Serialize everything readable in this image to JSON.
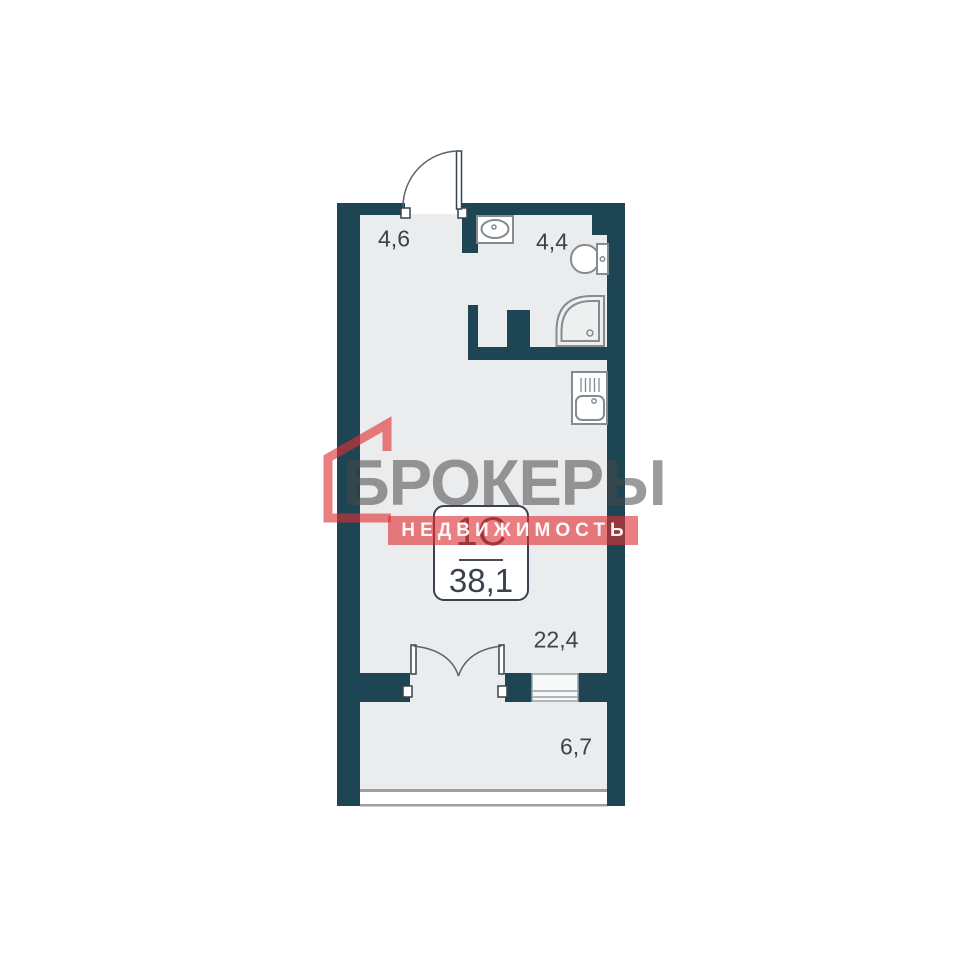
{
  "logo": {
    "brand": "БРОКЕРЫ",
    "subtitle": "НЕДВИЖИМОСТЬ",
    "brand_gray": "#484848",
    "accent_red": "#df2f32"
  },
  "unit_card": {
    "type": "1С",
    "area": "38,1"
  },
  "rooms": {
    "hallway": {
      "area": "4,6"
    },
    "bathroom": {
      "area": "4,4"
    },
    "living": {
      "area": "22,4"
    },
    "balcony": {
      "area": "6,7"
    }
  },
  "colors": {
    "wall": "#1e4553",
    "floor": "#ebeced",
    "fixture_stroke": "#848b91",
    "door_stroke": "#5a646c",
    "window_frame": "#9aa0a6",
    "label_text": "#3b434d"
  },
  "icons": {
    "bath_sink": "sink-icon",
    "toilet": "toilet-icon",
    "shower": "shower-icon",
    "kitchen_sink": "kitchen-sink-icon",
    "entry_door": "door-swing-icon",
    "balcony_doors": "double-door-swing-icon",
    "logo_house": "house-outline-icon"
  }
}
